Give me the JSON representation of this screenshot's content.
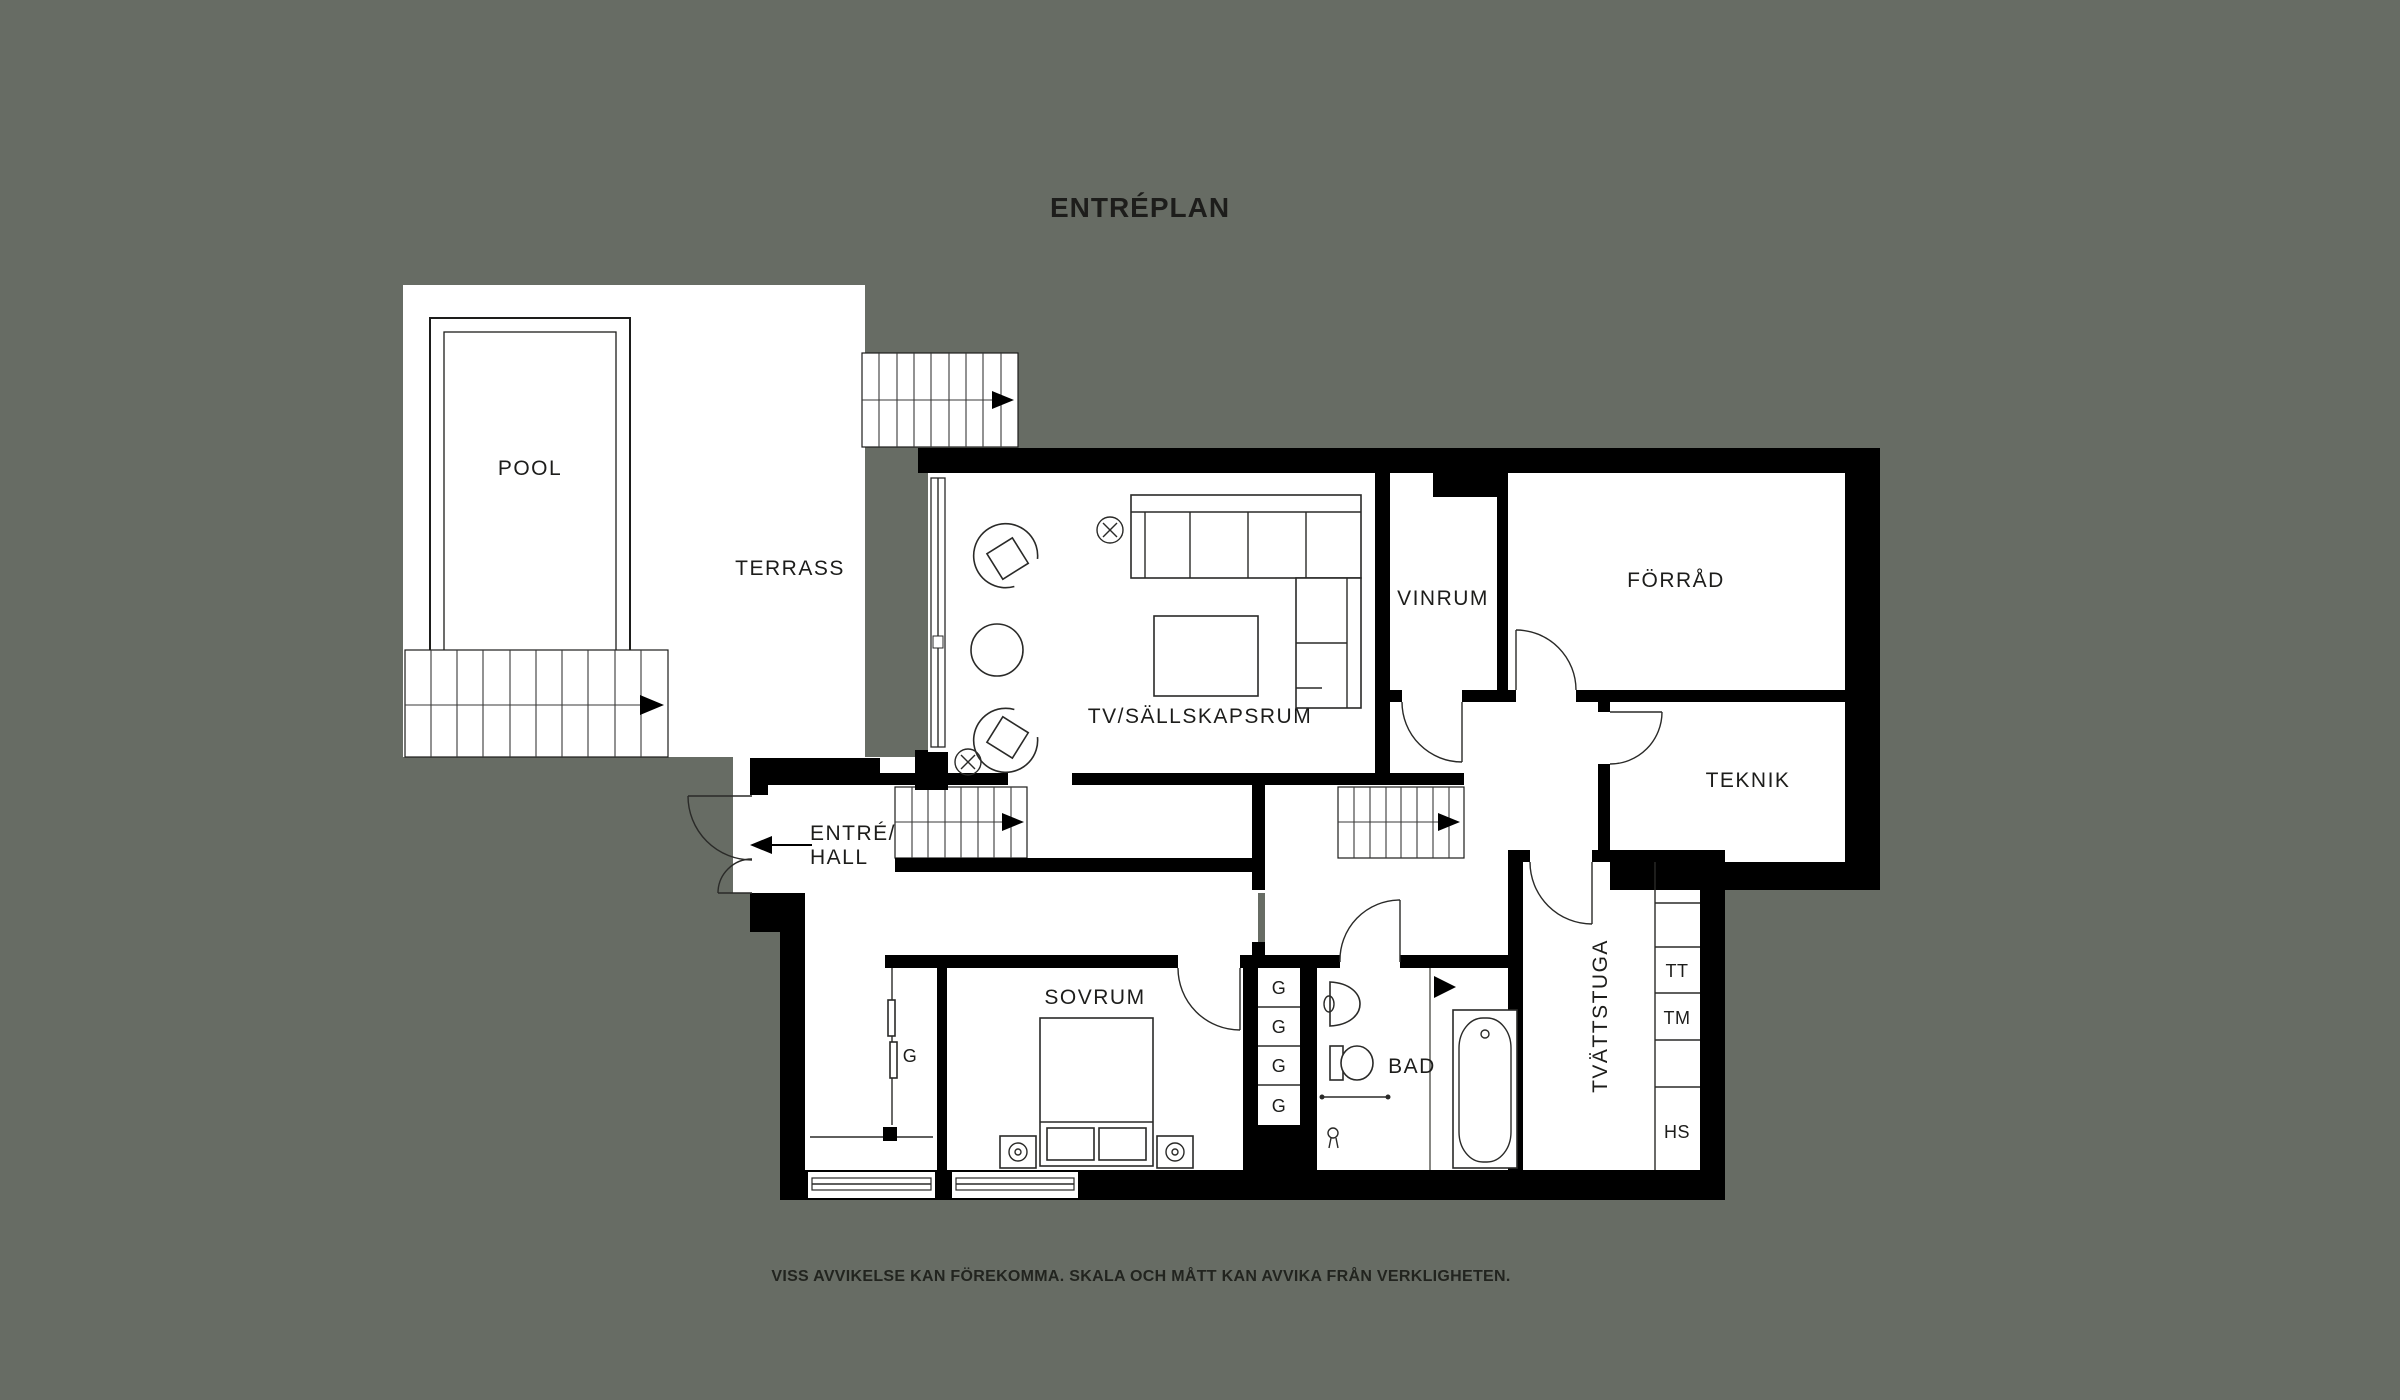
{
  "title": "ENTRÉPLAN",
  "disclaimer": "VISS AVVIKELSE KAN FÖREKOMMA. SKALA OCH MÅTT KAN AVVIKA FRÅN VERKLIGHETEN.",
  "rooms": {
    "pool": "POOL",
    "terrass": "TERRASS",
    "tv_room": "TV/SÄLLSKAPSRUM",
    "vinrum": "VINRUM",
    "forrad": "FÖRRÅD",
    "teknik": "TEKNIK",
    "entre_line1": "ENTRÉ/",
    "entre_line2": "HALL",
    "sovrum": "SOVRUM",
    "bad": "BAD",
    "tvattstuga": "TVÄTTSTUGA"
  },
  "closets": {
    "hall_g": "G",
    "g1": "G",
    "g2": "G",
    "g3": "G",
    "g4": "G"
  },
  "appliances": {
    "tt": "TT",
    "tm": "TM",
    "hs": "HS"
  },
  "icons": {
    "stair_direction": "right-arrow",
    "entry_direction": "left-arrow",
    "ceiling_lamp": "circle-cross"
  },
  "colors": {
    "background": "#676c64",
    "floor": "#ffffff",
    "wall": "#000000",
    "text": "#1d1d1b"
  }
}
